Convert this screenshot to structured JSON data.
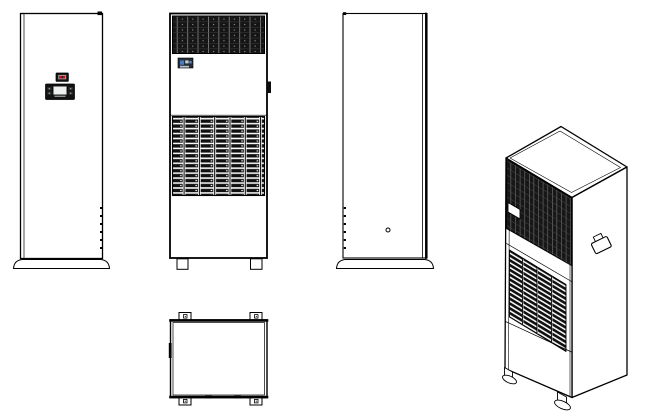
{
  "canvas": {
    "width": 653,
    "height": 419,
    "background": "#ffffff"
  },
  "colors": {
    "line": "#000000",
    "panel_dark": "#141414",
    "led_red": "#c3161c",
    "logo_blue": "#4a7dbf",
    "logo_grey": "#c7cdd4",
    "logo_bg": "#232e3a",
    "screen_grey": "#eef0ef"
  },
  "figure": {
    "subject": "cabinet-air-conditioner-unit-multiview-technical-drawing",
    "views": [
      {
        "id": "front-view-control-panel",
        "projection": "orthographic",
        "features": [
          "controller-display",
          "status-led",
          "side-vent-slots",
          "plinth-base",
          "corner-mark"
        ]
      },
      {
        "id": "front-view-grilles",
        "projection": "orthographic",
        "features": [
          "top-air-grille",
          "brand-label",
          "door-handle",
          "louver-grille",
          "mounting-feet"
        ]
      },
      {
        "id": "side-view",
        "projection": "orthographic",
        "features": [
          "vent-slots",
          "pilot-hole",
          "plinth-base",
          "double-edge-line"
        ]
      },
      {
        "id": "top-view",
        "projection": "orthographic",
        "features": [
          "corner-mounting-tabs",
          "tab-holes",
          "edge-marks"
        ]
      },
      {
        "id": "isometric-view",
        "projection": "isometric",
        "features": [
          "top-face",
          "top-air-grille",
          "brand-label",
          "louver-grille",
          "side-handle",
          "leveling-feet"
        ]
      }
    ]
  }
}
